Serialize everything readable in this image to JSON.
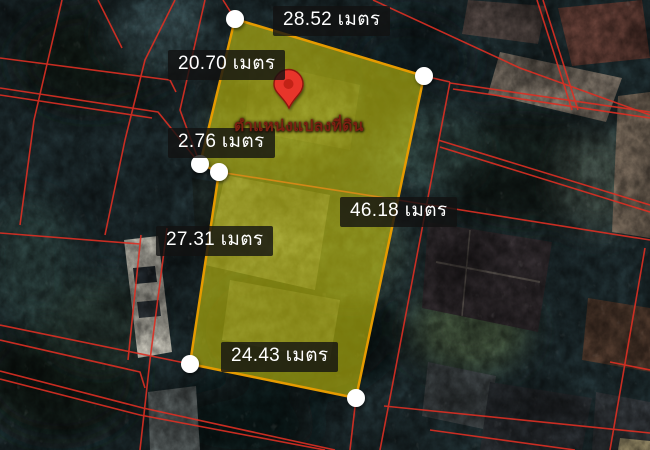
{
  "parcel": {
    "pin_caption": "ตำแหน่งแปลงที่ดิน",
    "measurements": [
      {
        "side": "top",
        "label": "28.52 เมตร"
      },
      {
        "side": "upper-left",
        "label": "20.70 เมตร"
      },
      {
        "side": "left-jog",
        "label": "2.76 เมตร"
      },
      {
        "side": "right",
        "label": "46.18 เมตร"
      },
      {
        "side": "lower-left",
        "label": "27.31 เมตร"
      },
      {
        "side": "bottom",
        "label": "24.43 เมตร"
      }
    ]
  },
  "colors": {
    "parcel_fill": "#d9d60e",
    "parcel_border": "#e69b00",
    "cadastral_line": "#dd2f23",
    "label_background": "#111111",
    "label_text": "#ffffff",
    "pin_red": "#e8342c",
    "pin_caption_text": "#7a2012",
    "vertex_marker": "#ffffff"
  }
}
